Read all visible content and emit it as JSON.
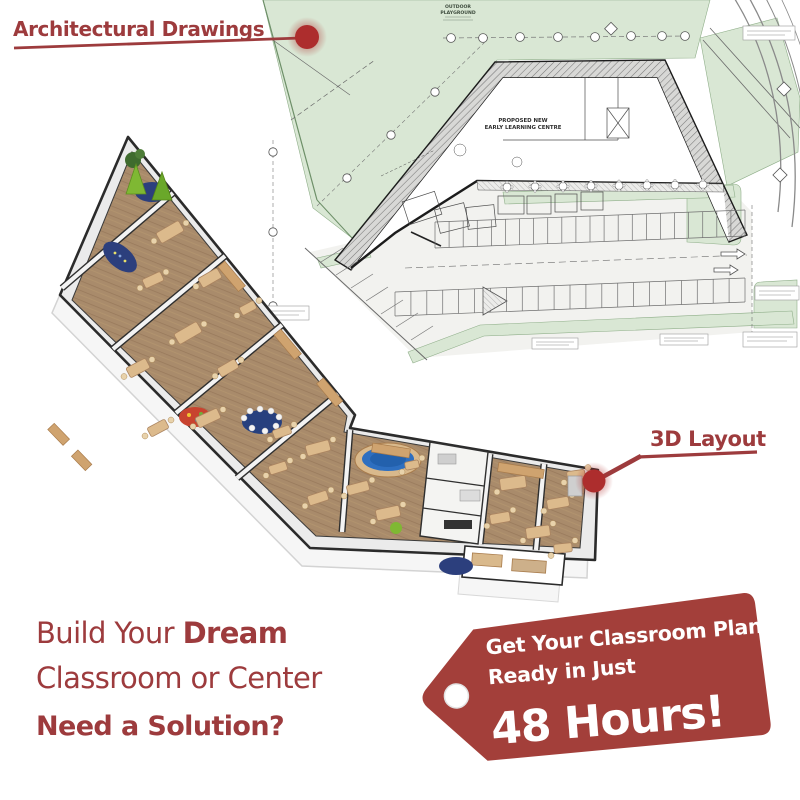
{
  "colors": {
    "accent": "#9d3b3d",
    "dot": "#ad2d2d",
    "tag_bg": "#a33f3a",
    "tag_text": "#ffffff",
    "drawing_green": "#d9e7d4",
    "floor_wood": "#a98b6b",
    "rug_blue": "#2c3f7d",
    "pool_blue": "#2e6fc0",
    "tent_green": "#7fb833"
  },
  "callouts": {
    "architectural_label": "Architectural Drawings",
    "layout3d_label": "3D Layout"
  },
  "headline": {
    "line1_regular": "Build Your",
    "line1_bold": "Dream",
    "line2": "Classroom or Center",
    "line3": "Need a Solution?"
  },
  "tag": {
    "line1": "Get Your Classroom Plan",
    "line2": "Ready in Just",
    "highlight": "48 Hours!"
  },
  "drawing": {
    "playground_l1": "OUTDOOR",
    "playground_l2": "PLAYGROUND",
    "building_l1": "PROPOSED NEW",
    "building_l2": "EARLY LEARNING CENTRE"
  }
}
